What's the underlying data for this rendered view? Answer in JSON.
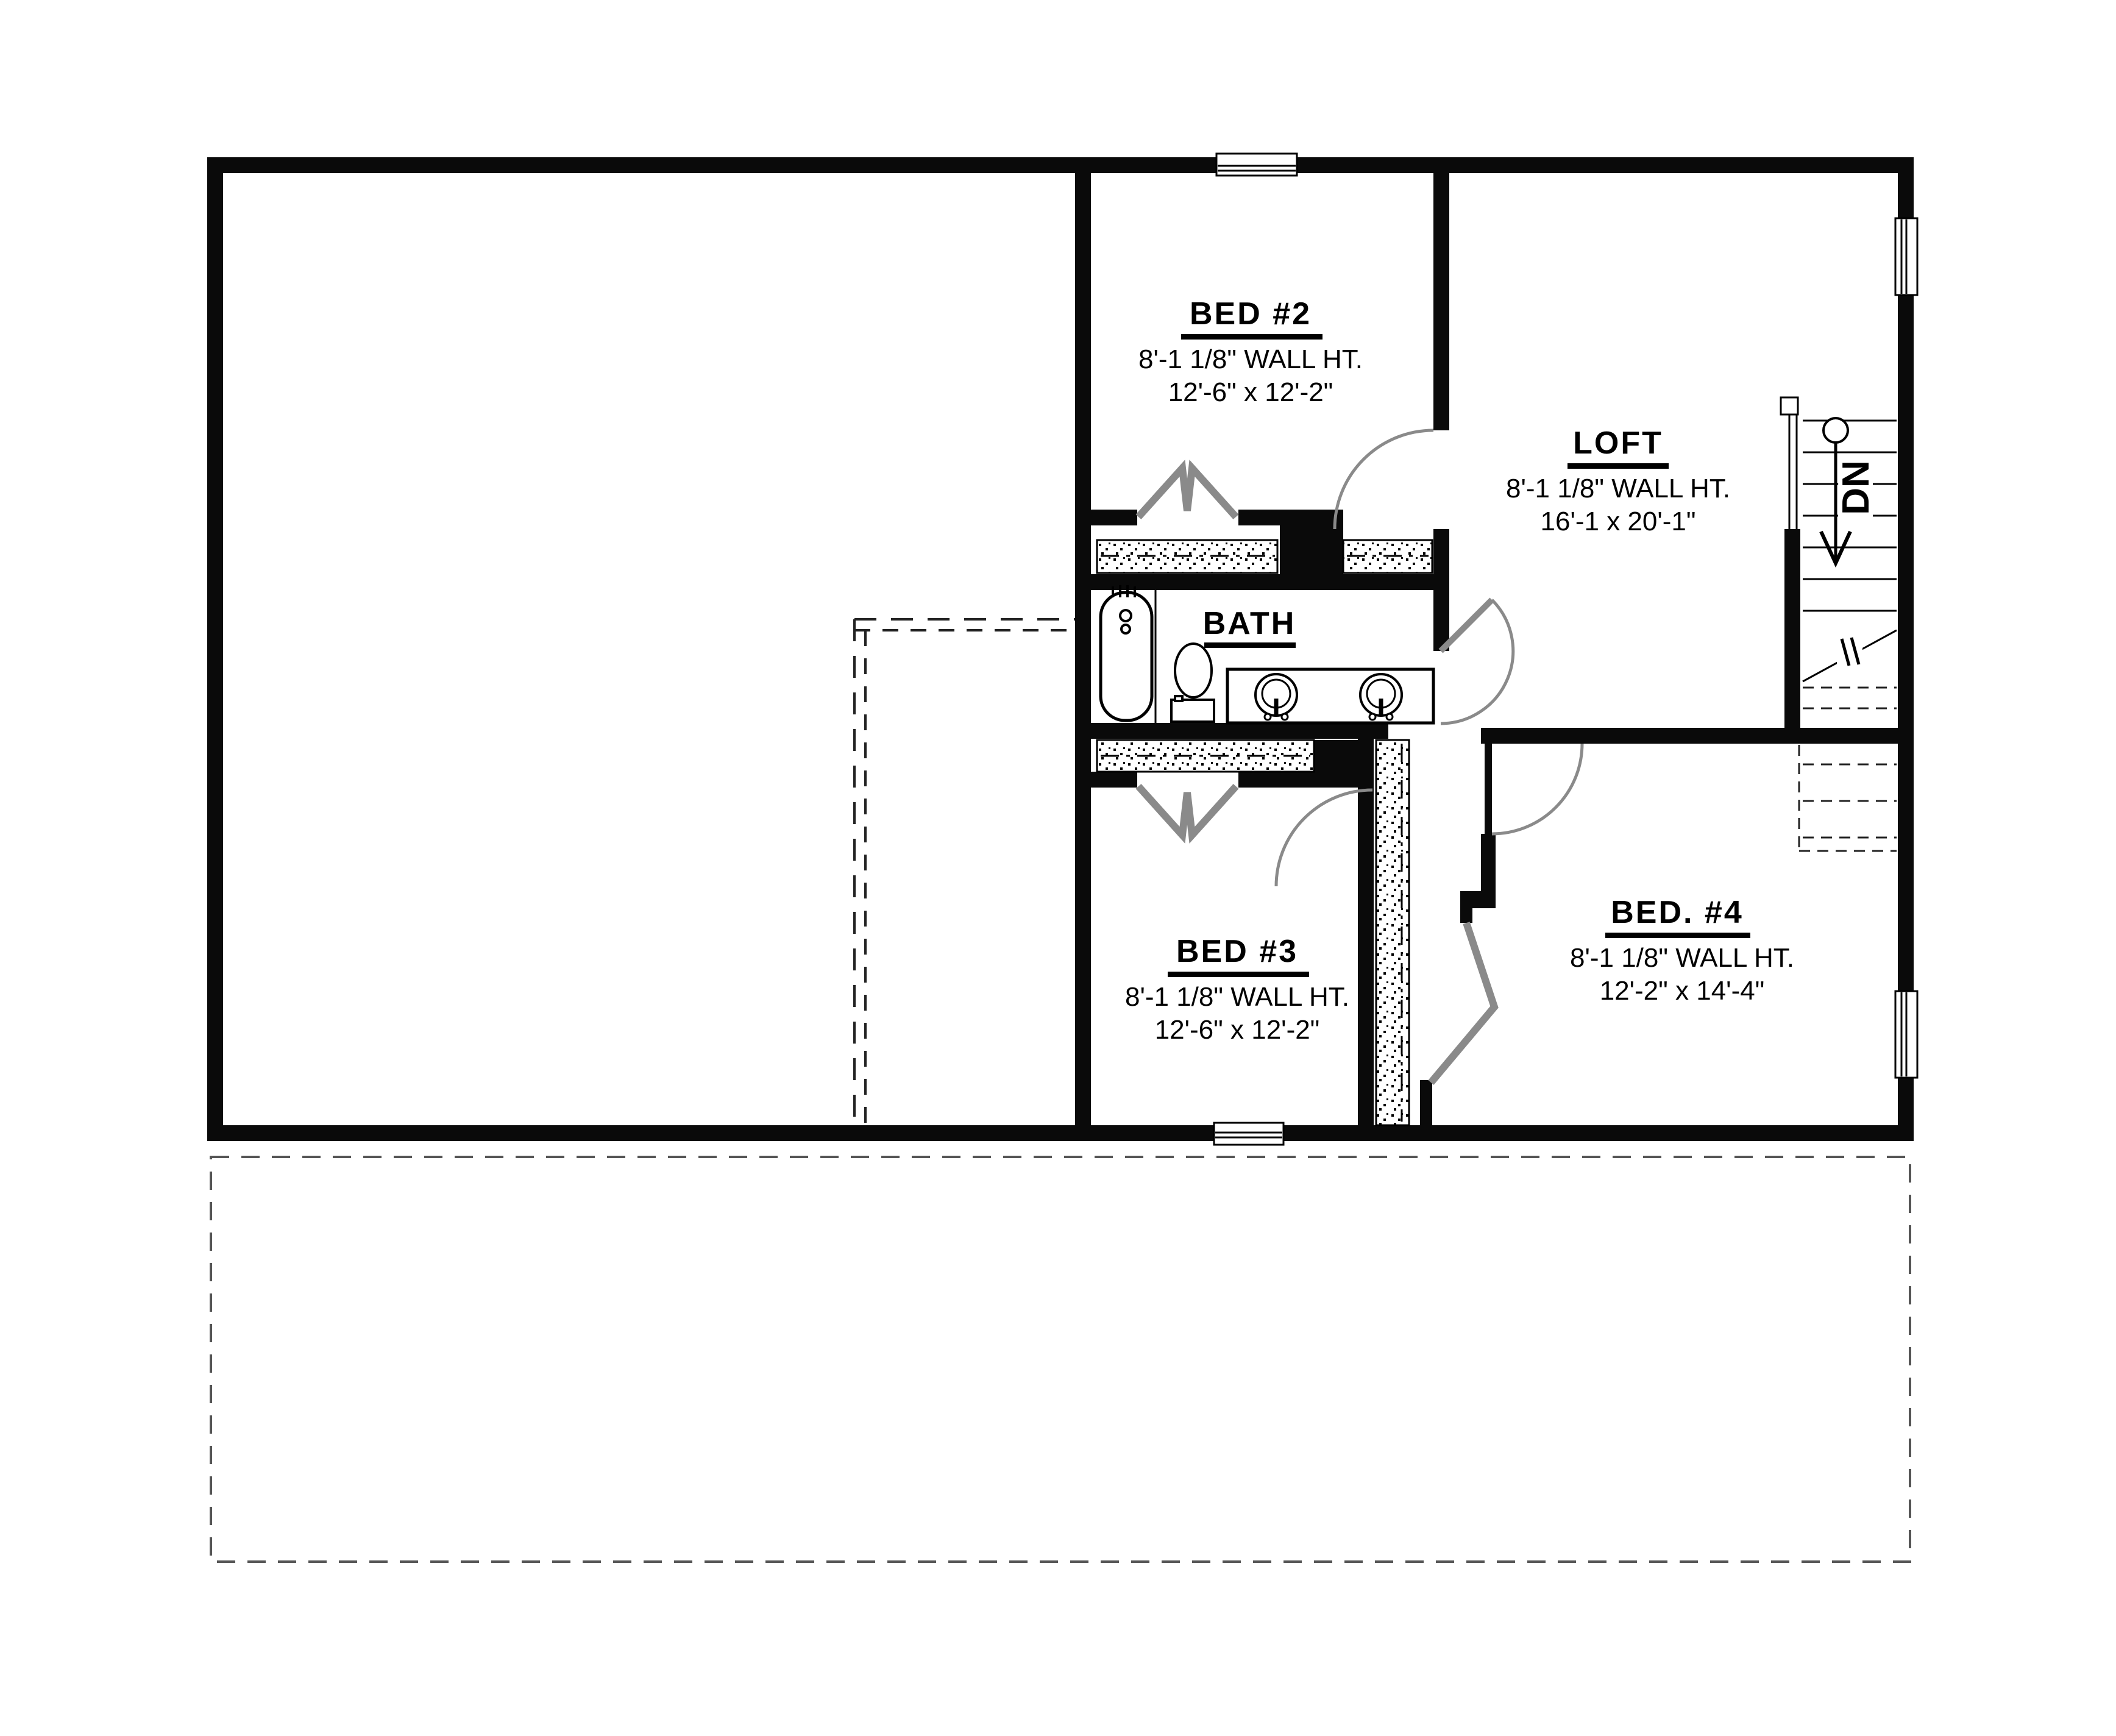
{
  "title": "Second floor plan",
  "rooms": {
    "bed2": {
      "name": "BED #2",
      "wall_ht": "8'-1 1/8\" WALL HT.",
      "size": "12'-6\" x 12'-2\""
    },
    "loft": {
      "name": "LOFT",
      "wall_ht": "8'-1 1/8\" WALL HT.",
      "size": "16'-1 x 20'-1\""
    },
    "bath": {
      "name": "BATH"
    },
    "bed3": {
      "name": "BED #3",
      "wall_ht": "8'-1 1/8\" WALL HT.",
      "size": "12'-6\" x 12'-2\""
    },
    "bed4": {
      "name": "BED. #4",
      "wall_ht": "8'-1 1/8\" WALL HT.",
      "size": "12'-2\" x 14'-4\""
    }
  },
  "stairs": {
    "label": "DN"
  },
  "colors": {
    "wall": "#0a0a0a",
    "door": "#8a8a8a",
    "dash": "#444444"
  }
}
